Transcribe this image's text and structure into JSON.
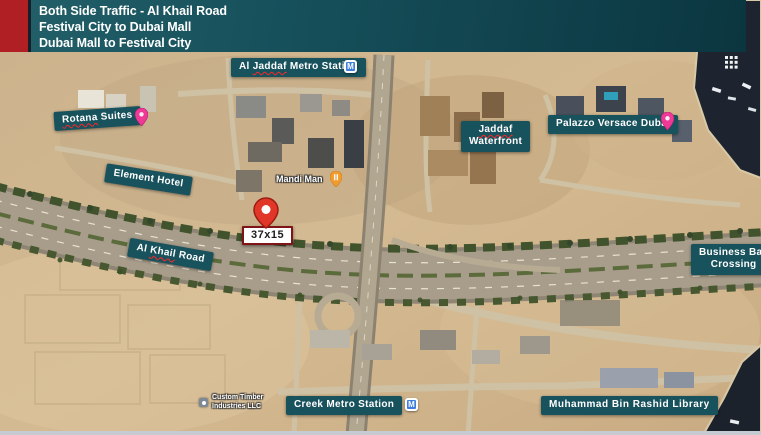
{
  "header": {
    "line1": "Both Side Traffic - Al Khail Road",
    "line2": "Festival City to Dubai Mall",
    "line3": "Dubai Mall to Festival City",
    "accent_color": "#b01f24",
    "teal_gradient_from": "#236069",
    "teal_gradient_to": "#0b3640"
  },
  "map": {
    "labels": {
      "al_jaddaf_metro": {
        "part1": "Al ",
        "mis": "Jaddaf",
        "part2": " Metro Station"
      },
      "rotana": {
        "mis": "Rotana",
        "part2": " Suites"
      },
      "element_hotel": {
        "text": "Element Hotel"
      },
      "mandi_man": {
        "text": "Mandi Man"
      },
      "billboard_size": {
        "text": "37x15"
      },
      "al_khail_road": {
        "part1": "Al ",
        "mis": "Khail",
        "part2": " Road"
      },
      "jaddaf_waterfront": {
        "mis": "Jaddaf",
        "line2": "Waterfront"
      },
      "palazzo_versace": {
        "text": "Palazzo Versace Dubai"
      },
      "business_bay": {
        "line1": "Business Bay",
        "line2": "Crossing"
      },
      "creek_metro": {
        "text": "Creek Metro Station"
      },
      "custom_timber": {
        "line1": "Custom Timber",
        "line2": "Industries LLC"
      },
      "mbr_library": {
        "text": "Muhammad Bin Rashid Library"
      }
    },
    "metro_letter": "M",
    "colors": {
      "label_bg": "#18525d",
      "metro_blue": "#3d7fd9",
      "billboard_pin_red": "#e03728",
      "hotel_pin_pink": "#ee3a96",
      "restaurant_pin_orange": "#f39b2d"
    }
  }
}
